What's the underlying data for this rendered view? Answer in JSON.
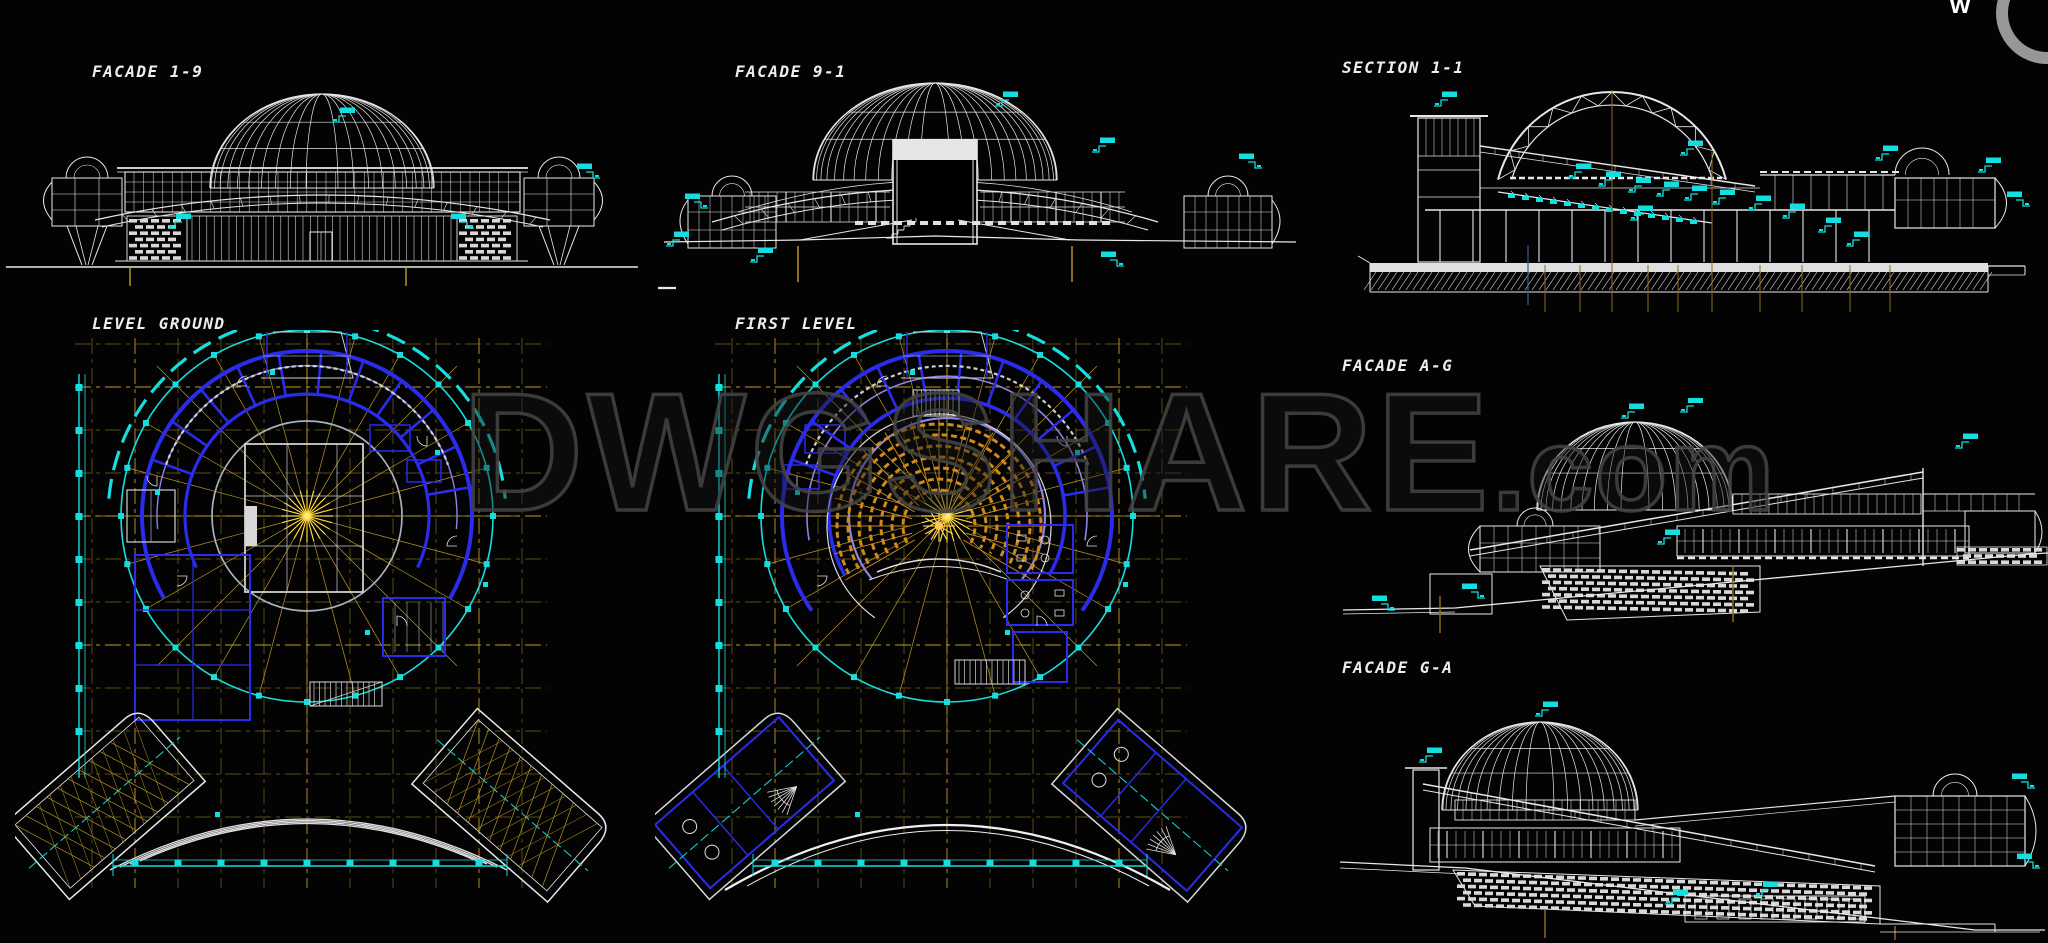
{
  "page": {
    "width": 2048,
    "height": 943,
    "background": "#030303",
    "description": "CAD drawing sheet of a domed planetarium building: four facades, one section and two floor plans on a black model-space background"
  },
  "drawings": {
    "facade_1_9": {
      "label": "FACADE 1-9",
      "kind": "front elevation",
      "features": [
        "ribbed central dome",
        "glazed curtain-wall band",
        "brick base panels",
        "two side pods with small domes on splayed legs",
        "cyan elevation markers"
      ]
    },
    "facade_9_1": {
      "label": "FACADE 9-1",
      "kind": "rear elevation",
      "features": [
        "ribbed dome",
        "central portal with solid white lintel",
        "curved saucer rim",
        "side pods with small domes",
        "sloped ground berm",
        "cyan elevation markers"
      ]
    },
    "section_1_1": {
      "label": "SECTION 1-1",
      "kind": "building section",
      "features": [
        "trussed dome arch",
        "raked auditorium seating",
        "left stair tower",
        "right pod with small dome",
        "hatched foundation strip",
        "cyan level markers",
        "olive grid axes"
      ]
    },
    "level_ground": {
      "label": "LEVEL GROUND",
      "kind": "floor plan",
      "features": [
        "circular plan with cyan perimeter ring",
        "blue radial walls",
        "yellow structural grid and radial axes",
        "central square hall",
        "two rotated entrance wings",
        "white canopy arcs",
        "cyan dimension lines"
      ]
    },
    "first_level": {
      "label": "FIRST LEVEL",
      "kind": "floor plan",
      "features": [
        "circular plan with cyan perimeter ring",
        "blue concentric walls",
        "orange amphitheater seating fan",
        "yellow structural grid and radial axes",
        "two rotated wings",
        "white canopy arc",
        "cyan dimension lines"
      ]
    },
    "facade_a_g": {
      "label": "FACADE A-G",
      "kind": "side elevation",
      "features": [
        "dome",
        "long diagonal ramp rising to the right",
        "brick base",
        "window band",
        "sloping ground line",
        "cyan elevation markers"
      ]
    },
    "facade_g_a": {
      "label": "FACADE G-A",
      "kind": "side elevation",
      "features": [
        "dome",
        "long diagonal ramp falling to the right",
        "large brick base",
        "window band",
        "right glazed pod with small dome",
        "cyan elevation markers"
      ]
    }
  },
  "watermark": {
    "full": "DWGSHARE.com",
    "main": "DWGSHARE",
    "suffix": ".com"
  },
  "corner_logo": {
    "letter": "w"
  },
  "palette": {
    "line_white": "#e8e8e8",
    "cyan": "#16dede",
    "blue_wall": "#2b2bea",
    "violet_wall": "#8d83e8",
    "grid_olive": "#7a671d",
    "grid_yellow": "#bf9a28",
    "center_yellow": "#ffd83a",
    "seating_orange": "#d08a18",
    "watermark_gray": "#424242"
  }
}
